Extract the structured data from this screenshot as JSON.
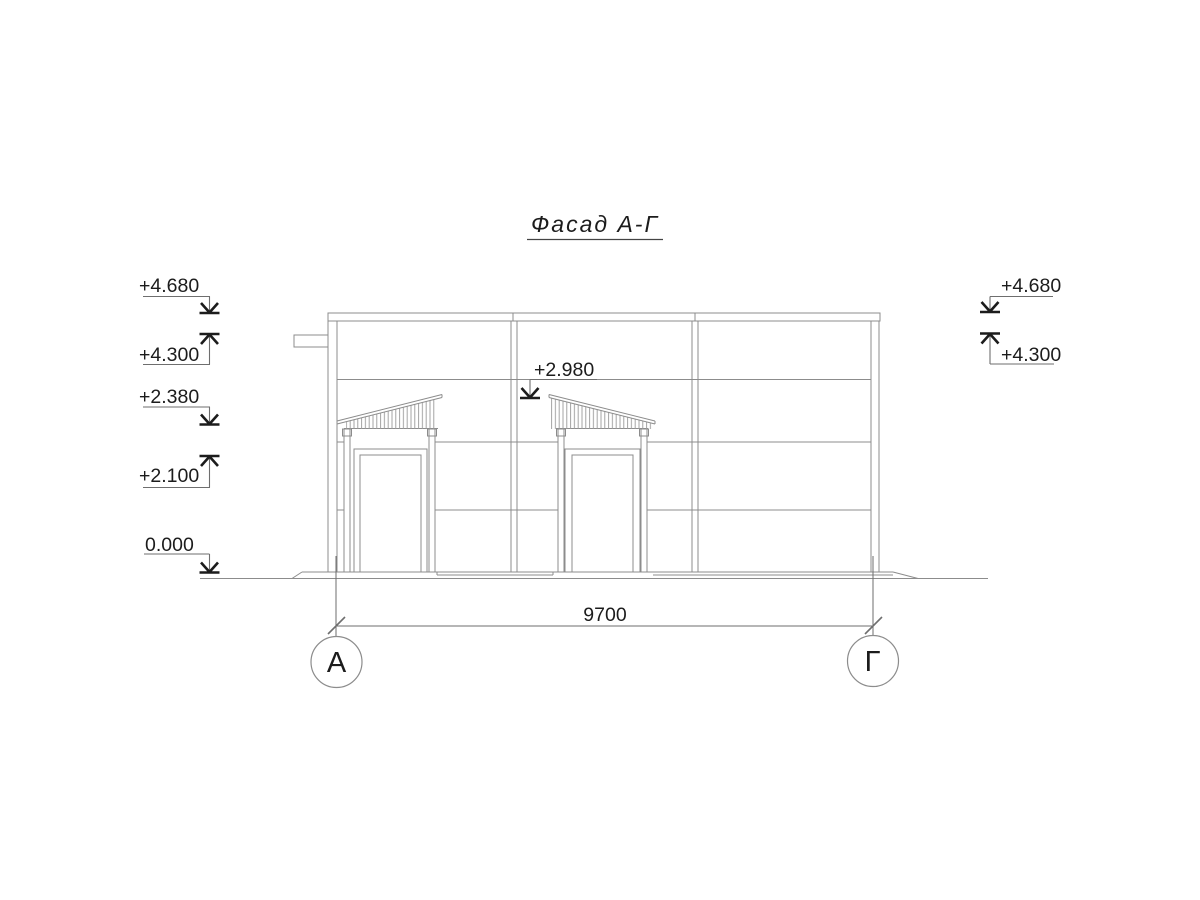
{
  "drawing_title": "Фасад А-Г",
  "elevation_marks": {
    "left": [
      {
        "value": "+4.680",
        "direction": "down"
      },
      {
        "value": "+4.300",
        "direction": "up"
      },
      {
        "value": "+2.380",
        "direction": "down"
      },
      {
        "value": "+2.100",
        "direction": "up"
      },
      {
        "value": "0.000",
        "direction": "down"
      }
    ],
    "right": [
      {
        "value": "+4.680",
        "direction": "down"
      },
      {
        "value": "+4.300",
        "direction": "up"
      }
    ],
    "center": [
      {
        "value": "+2.980",
        "direction": "down"
      }
    ]
  },
  "dimensions": {
    "overall_width": "9700"
  },
  "axis_markers": [
    {
      "label": "А"
    },
    {
      "label": "Г"
    }
  ],
  "colors": {
    "building_line": "#8c8c8c",
    "ink": "#1c1c1c",
    "background": "#ffffff"
  }
}
